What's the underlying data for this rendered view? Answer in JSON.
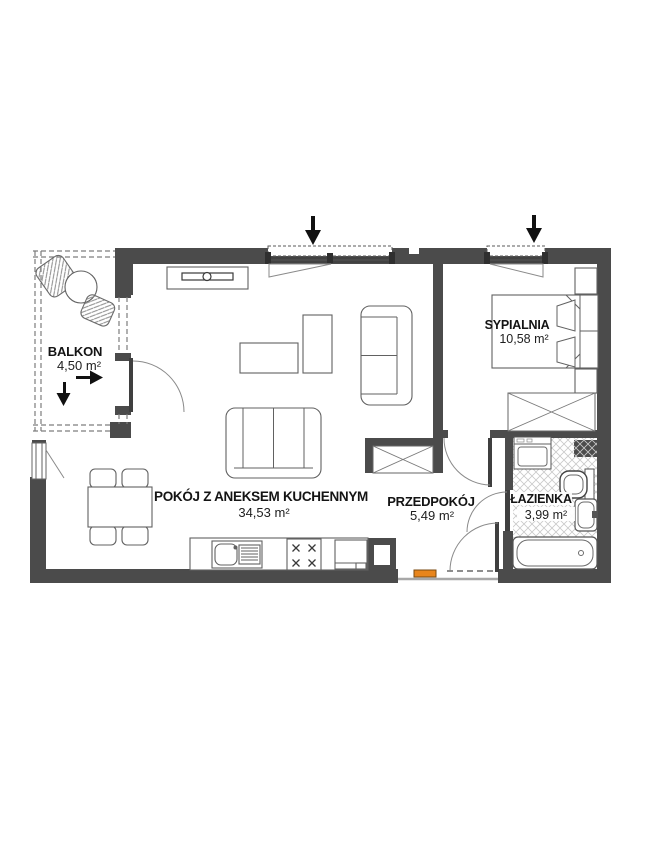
{
  "plan": {
    "type": "apartment-floor-plan",
    "rooms": {
      "balkon": {
        "name": "BALKON",
        "area": "4,50 m²"
      },
      "living": {
        "name": "POKÓJ Z ANEKSEM KUCHENNYM",
        "area": "34,53 m²"
      },
      "hall": {
        "name": "PRZEDPOKÓJ",
        "area": "5,49 m²"
      },
      "bath": {
        "name": "ŁAZIENKA",
        "area": "3,99 m²"
      },
      "bedroom": {
        "name": "SYPIALNIA",
        "area": "10,58 m²"
      }
    },
    "colors": {
      "wall": "#4b4b4b",
      "accent_orange": "#e8851c",
      "furniture_line": "#616161",
      "hatch": "#c9c9c9"
    }
  }
}
